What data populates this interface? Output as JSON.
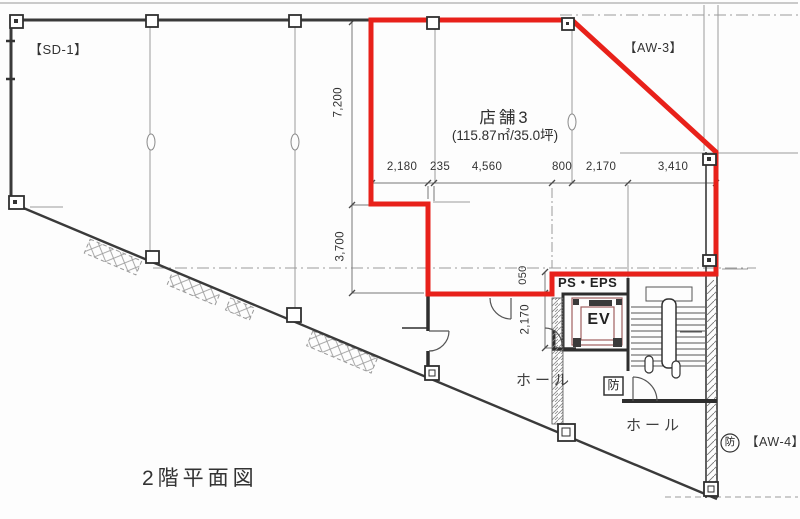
{
  "page": {
    "title": "2階平面図"
  },
  "labels": {
    "sd1": "【SD-1】",
    "aw3": "【AW-3】",
    "aw4": "【AW-4】",
    "tenant_name": "店舗3",
    "tenant_area": "(115.87㎡/35.0坪)",
    "ps_eps": "PS・EPS",
    "elevator": "EV",
    "hall_upper": "ホール",
    "hall_lower": "ホール",
    "fire_shutter_box": "防",
    "fire_shutter_circle": "防"
  },
  "dimensions": {
    "top_row": [
      "2,180",
      "235",
      "4,560",
      "800",
      "2,170",
      "3,410"
    ],
    "left_column": [
      "7,200",
      "3,700"
    ],
    "center_column": [
      "050",
      "2,170"
    ]
  },
  "colors": {
    "tenant_outline_red": "#e8211a",
    "wall": "#3a3a3a",
    "grid": "#9a9a9a"
  }
}
